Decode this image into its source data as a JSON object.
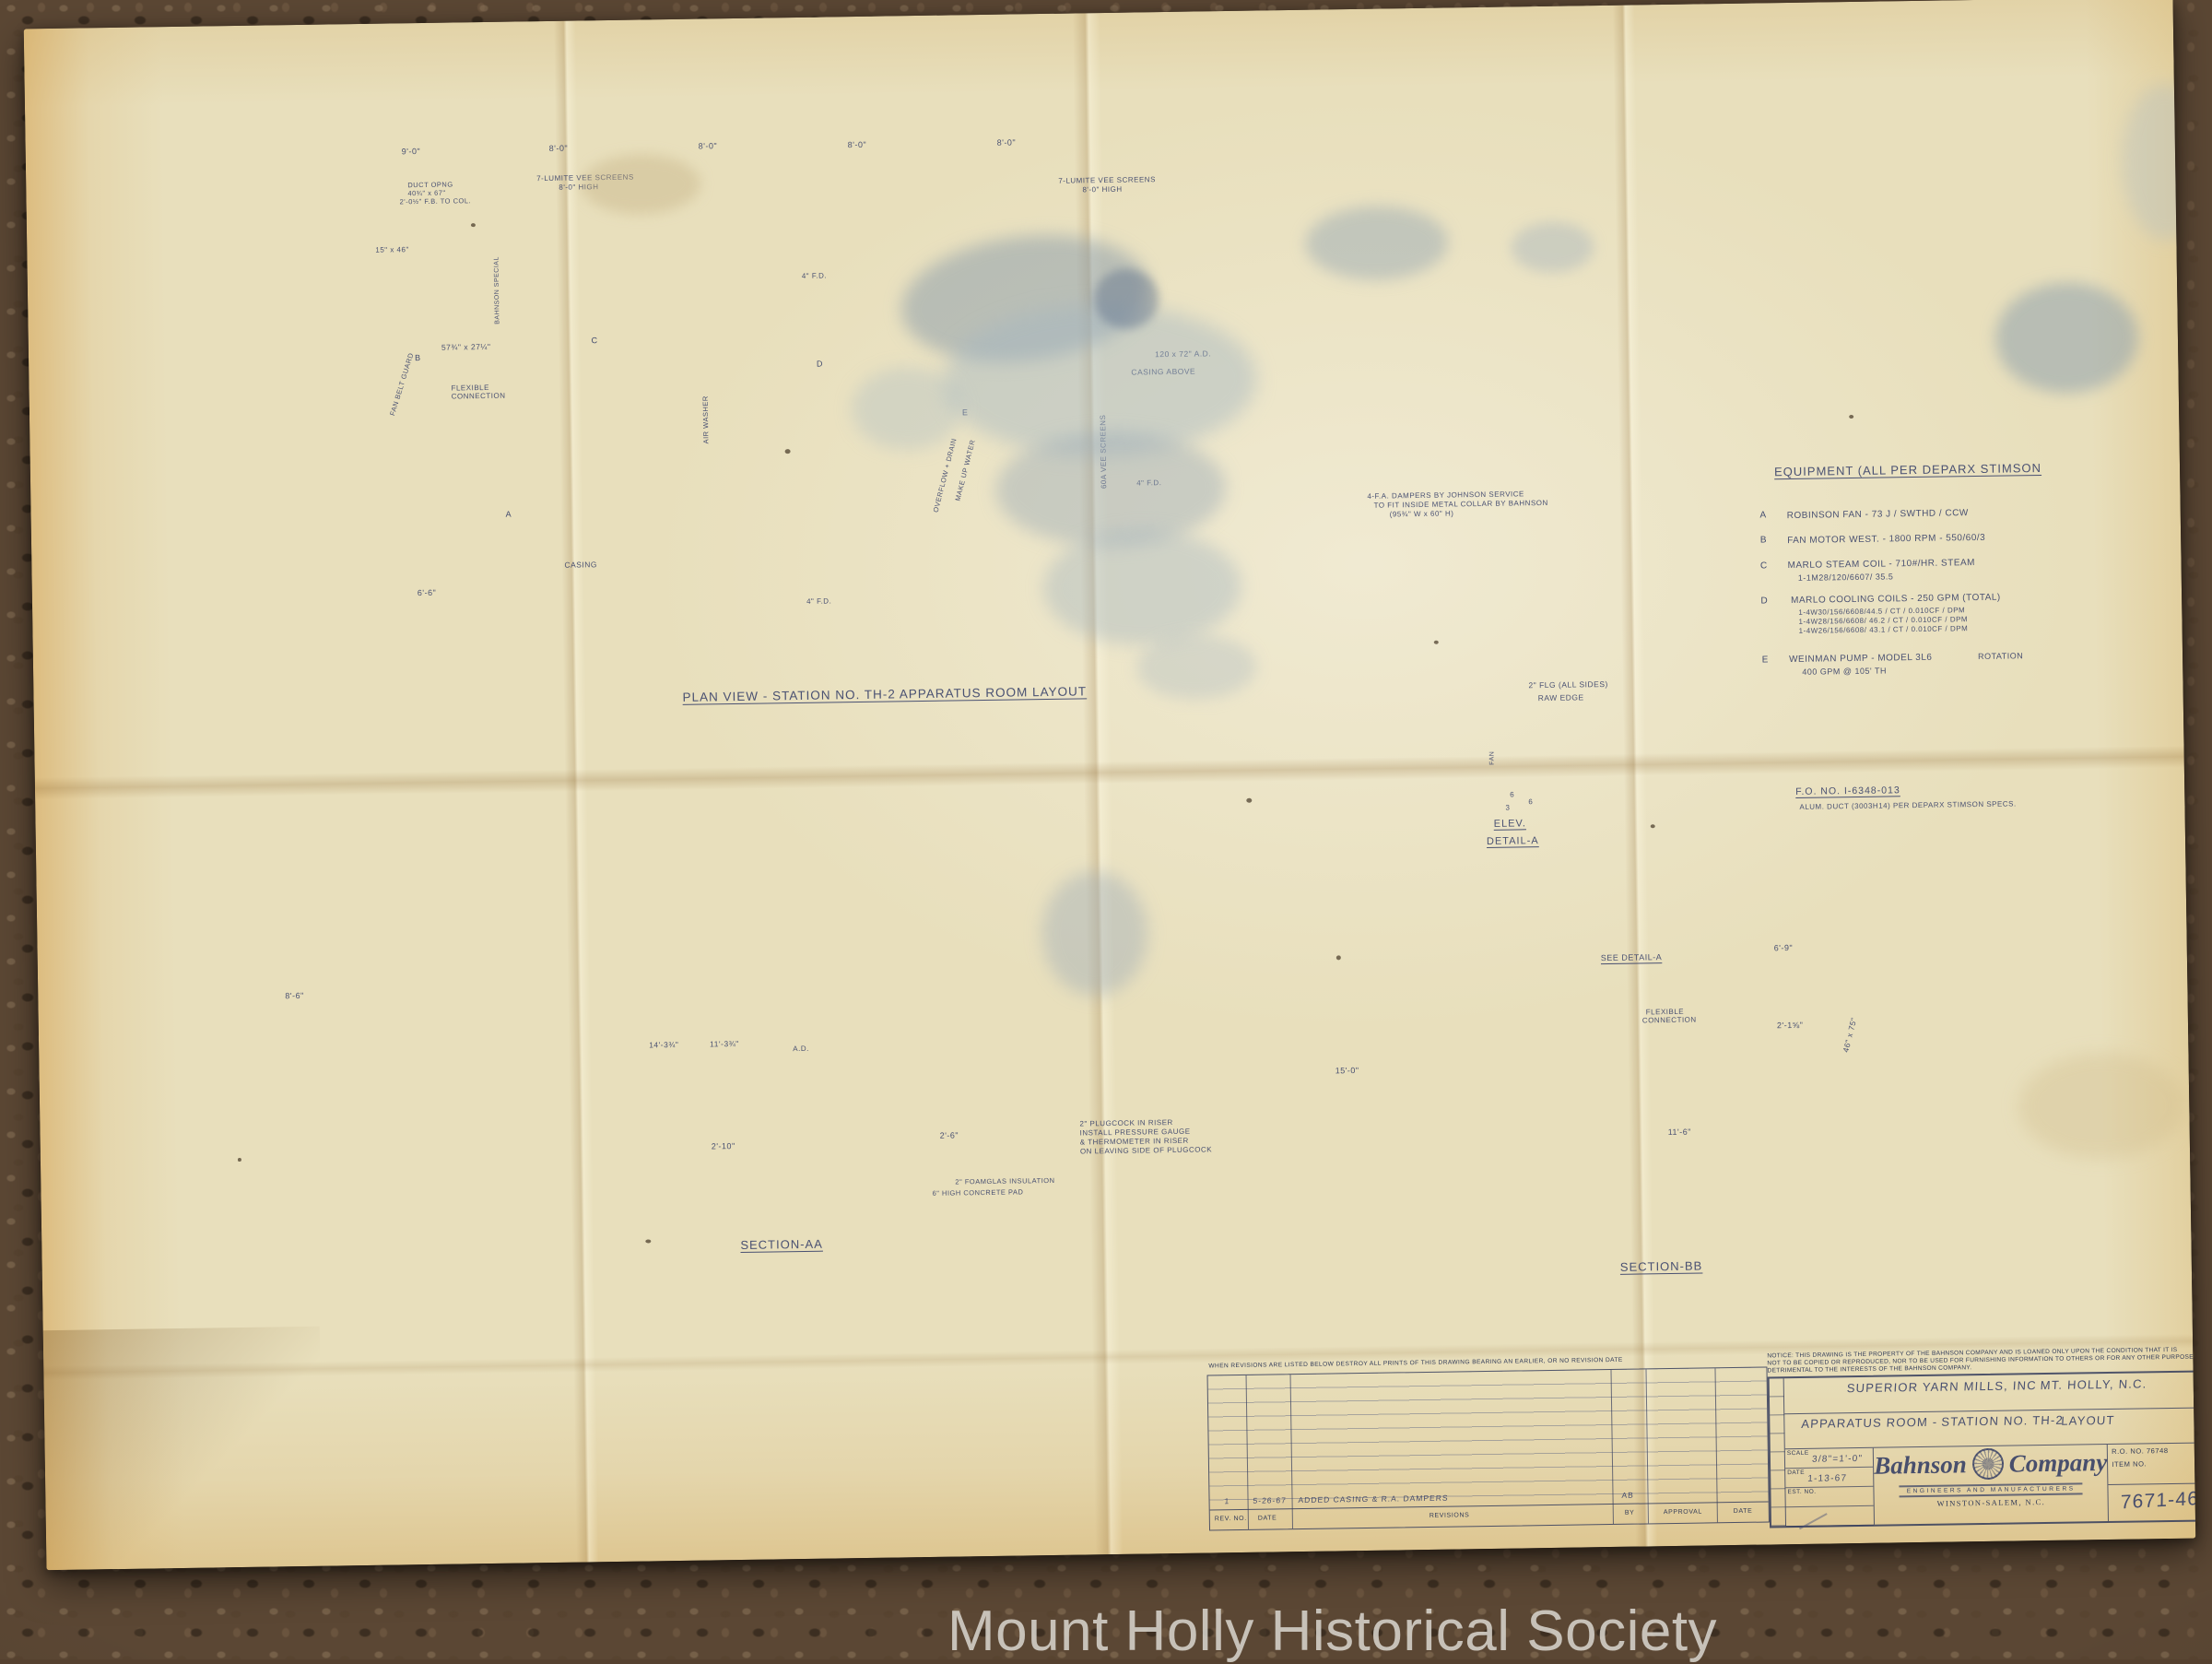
{
  "watermark": "Mount Holly Historical Society",
  "plan": {
    "caption": "PLAN VIEW - STATION NO. TH-2 APPARATUS ROOM LAYOUT",
    "dims": {
      "d1": "9'-0\"",
      "d2": "8'-0\"",
      "d3": "8'-0\"",
      "d4": "8'-0\"",
      "d5": "8'-0\""
    },
    "screen1a": "7-LUMITE VEE SCREENS",
    "screen1b": "8'-0\" HIGH",
    "screen2a": "7-LUMITE VEE SCREENS",
    "screen2b": "8'-0\" HIGH",
    "duct1": "DUCT OPNG",
    "duct2": "40¾\" x 67\"",
    "duct3": "2'-0½\" F.B. TO COL.",
    "size1": "15\" x 46\"",
    "size2": "57¾\" x 27¼\"",
    "flex1": "FLEXIBLE",
    "flex2": "CONNECTION",
    "beltguard": "FAN BELT GUARD",
    "casing": "CASING",
    "dim66": "6'-6\"",
    "fd": "4\" F.D.",
    "adnote": "120 x 72\" A.D.",
    "casingabove": "CASING ABOVE",
    "damper1": "4-F.A. DAMPERS BY JOHNSON SERVICE",
    "damper2": "TO FIT INSIDE METAL COLLAR BY BAHNSON",
    "damper3": "(95¾\" W x 60\" H)",
    "veevert": "60A VEE SCREENS",
    "overflow": "OVERFLOW + DRAIN",
    "makeup": "MAKE UP WATER",
    "washer1": "BAHNSON SPECIAL",
    "washer2": "AIR WASHER",
    "tagA": "A",
    "tagB": "B",
    "tagC": "C",
    "tagD": "D",
    "tagE": "E"
  },
  "equipment": {
    "title": "EQUIPMENT (ALL PER DEPARX STIMSON",
    "items": [
      {
        "tag": "A",
        "line": "ROBINSON FAN - 73 J / SWTHD / CCW"
      },
      {
        "tag": "B",
        "line": "FAN MOTOR WEST. - 1800 RPM - 550/60/3"
      },
      {
        "tag": "C",
        "line": "MARLO STEAM COIL - 710#/HR. STEAM",
        "sub1": "1-1M28/120/6607/ 35.5"
      },
      {
        "tag": "D",
        "line": "MARLO COOLING COILS - 250 GPM (TOTAL)",
        "sub1": "1-4W30/156/6608/44.5 / CT / 0.010CF / DPM",
        "sub2": "1-4W28/156/6608/ 46.2 / CT / 0.010CF / DPM",
        "sub3": "1-4W26/156/6608/ 43.1 / CT / 0.010CF / DPM"
      },
      {
        "tag": "E",
        "line": "WEINMAN PUMP - MODEL 3L6",
        "note": "ROTATION",
        "sub1": "400 GPM @ 105' TH"
      }
    ]
  },
  "fo": {
    "line1": "F.O. NO. I-6348-013",
    "line2": "ALUM. DUCT (3003H14) PER DEPARX STIMSON SPECS."
  },
  "detail": {
    "flg": "2\" FLG (ALL SIDES)",
    "raw": "RAW EDGE",
    "fan": "FAN",
    "d6a": "6",
    "d3": "3",
    "d6b": "6",
    "cap1": "ELEV.",
    "cap2": "DETAIL-A"
  },
  "aa": {
    "caption": "SECTION-AA",
    "dimleft": "8'-6\"",
    "dim1": "14'-3¾\"",
    "dim2": "11'-3¾\"",
    "ad": "A.D.",
    "dim210": "2'-10\"",
    "dim26": "2'-6\"",
    "note1": "2\" PLUGCOCK IN RISER",
    "note2": "INSTALL PRESSURE GAUGE",
    "note3": "& THERMOMETER IN RISER",
    "note4": "ON LEAVING SIDE OF PLUGCOCK",
    "foamglas": "2\" FOAMGLAS INSULATION",
    "pad": "6\" HIGH CONCRETE PAD"
  },
  "bb": {
    "caption": "SECTION-BB",
    "seedetail": "SEE DETAIL-A",
    "flex1": "FLEXIBLE",
    "flex2": "CONNECTION",
    "dim69": "6'-9\"",
    "dim218": "2'-1⅝\"",
    "size4675": "46\" x 75\"",
    "dim150": "15'-0\"",
    "dim116": "11'-6\""
  },
  "titleblock": {
    "notice1": "NOTICE: THIS DRAWING IS THE PROPERTY OF THE BAHNSON COMPANY AND IS LOANED ONLY UPON THE CONDITION THAT IT IS",
    "notice2": "NOT TO BE COPIED OR REPRODUCED, NOR TO BE USED FOR FURNISHING INFORMATION TO OTHERS OR FOR ANY OTHER PURPOSE",
    "notice3": "DETRIMENTAL TO THE INTERESTS OF THE BAHNSON COMPANY.",
    "customer1": "SUPERIOR YARN MILLS, INC",
    "customer2": "MT. HOLLY, N.C.",
    "job1": "APPARATUS ROOM -",
    "job1b": "LAYOUT",
    "job2": "STATION NO. TH-2",
    "scalelabel": "SCALE",
    "scalevalue": "3/8\"=1'-0\"",
    "datelabel": "DATE",
    "datevalue": "1-13-67",
    "estlabel": "EST. NO.",
    "company1": "Bahnson",
    "company2": "Company",
    "companysub": "ENGINEERS AND MANUFACTURERS",
    "companycity": "WINSTON-SALEM, N.C.",
    "roline": "R.O. NO. 76748",
    "itemline": "ITEM NO.",
    "dwgno": "7671-46"
  },
  "revisions": {
    "note": "WHEN REVISIONS ARE LISTED BELOW DESTROY ALL PRINTS OF THIS DRAWING BEARING AN EARLIER, OR NO REVISION DATE",
    "revno": "1",
    "revdate": "5-26-67",
    "revdesc": "ADDED CASING & R.A. DAMPERS",
    "revby": "AB",
    "fno": "REV. NO.",
    "fdate": "DATE",
    "frev": "REVISIONS",
    "fby": "BY",
    "fapproval": "APPROVAL",
    "fdate2": "DATE"
  }
}
